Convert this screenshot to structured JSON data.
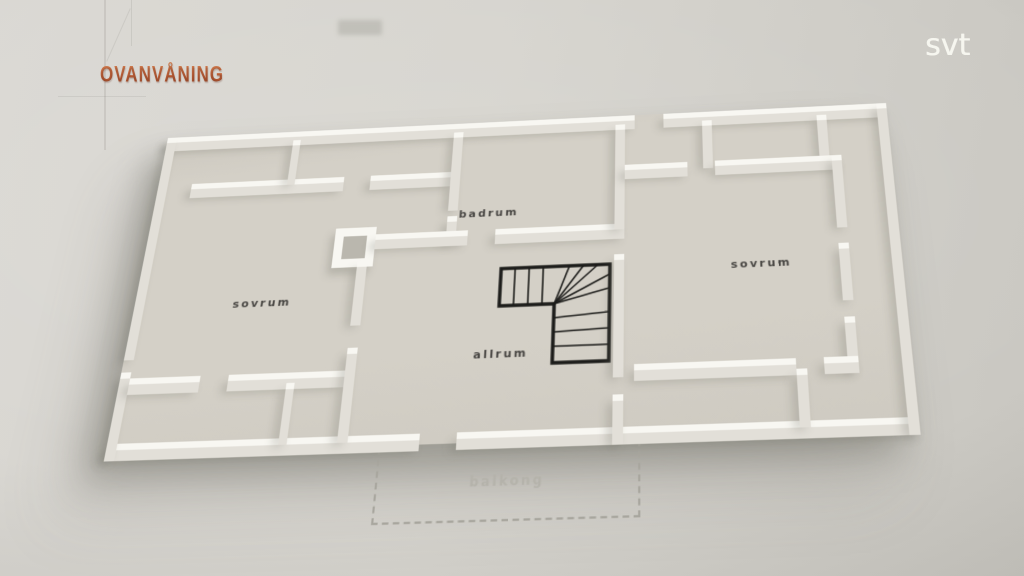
{
  "header": {
    "title": "OVANVÅNING"
  },
  "watermark": {
    "label": "svt"
  },
  "floor_plan": {
    "rooms": {
      "sovrum_left": {
        "label": "sovrum"
      },
      "badrum": {
        "label": "badrum"
      },
      "allrum": {
        "label": "allrum"
      },
      "sovrum_right": {
        "label": "sovrum"
      },
      "balkong": {
        "label": "balkong"
      }
    },
    "features": {
      "staircase": "l-shaped-winder-stair"
    }
  },
  "colors": {
    "title_accent": "#bf5b36",
    "paper_background": "#d5d3cd",
    "floor": "#d4d0c7",
    "wall": "#f8f7f2",
    "room_label": "#343230",
    "balcony_label": "#b4b2aa",
    "stair_outline": "#1c1c1a",
    "watermark": "#f6f5ef"
  }
}
